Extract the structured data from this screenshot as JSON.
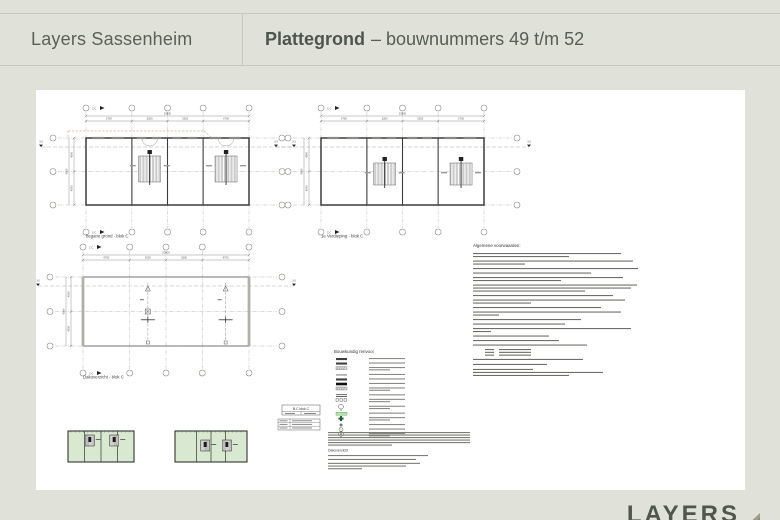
{
  "colors": {
    "background": "#e0e2da",
    "header_border": "#c6c9bc",
    "header_text": "#5a6156",
    "title_text": "#4d554c",
    "sheet": "#ffffff",
    "drawing_line": "#3c3c3c",
    "grid_line": "#9a9a92",
    "thumbnail_green": "#d9e8d1",
    "logo_text": "#51564b",
    "logo_triangle": "#a29c8b"
  },
  "header": {
    "brand": "Layers Sassenheim",
    "title_bold": "Plattegrond",
    "title_rest": "– bouwnummers 49 t/m 52"
  },
  "drawing": {
    "plans": [
      {
        "id": "begane-grond",
        "label": "begane grond - blok C",
        "type": "floor",
        "cols": [
          "6700",
          "5200",
          "5200",
          "6700"
        ],
        "cols_total": "23800",
        "rows": [
          "4500",
          "4500"
        ],
        "rows_total": "9000"
      },
      {
        "id": "1e-verdieping",
        "label": "1e Verdieping - blok C",
        "type": "floor",
        "cols": [
          "6700",
          "5200",
          "5200",
          "6700"
        ],
        "cols_total": "23800",
        "rows": [
          "4500",
          "4500"
        ],
        "rows_total": "9000"
      },
      {
        "id": "dakoverzicht",
        "label": "Dakoverzicht - blok C",
        "type": "roof",
        "cols": [
          "6700",
          "5200",
          "5200",
          "6700"
        ],
        "cols_total": "23800",
        "rows": [
          "4500",
          "4500"
        ],
        "rows_total": "9000"
      }
    ],
    "section_marker": "3-3",
    "detail_marker": "C-C",
    "legend_title": "Bouwkundig renvooi",
    "conditions_title": "Algemene voorwaarden:",
    "notes_title": "Dakoverzicht",
    "titleblock_title": "B.C blok C"
  },
  "logo": {
    "text": "LAYERS"
  }
}
